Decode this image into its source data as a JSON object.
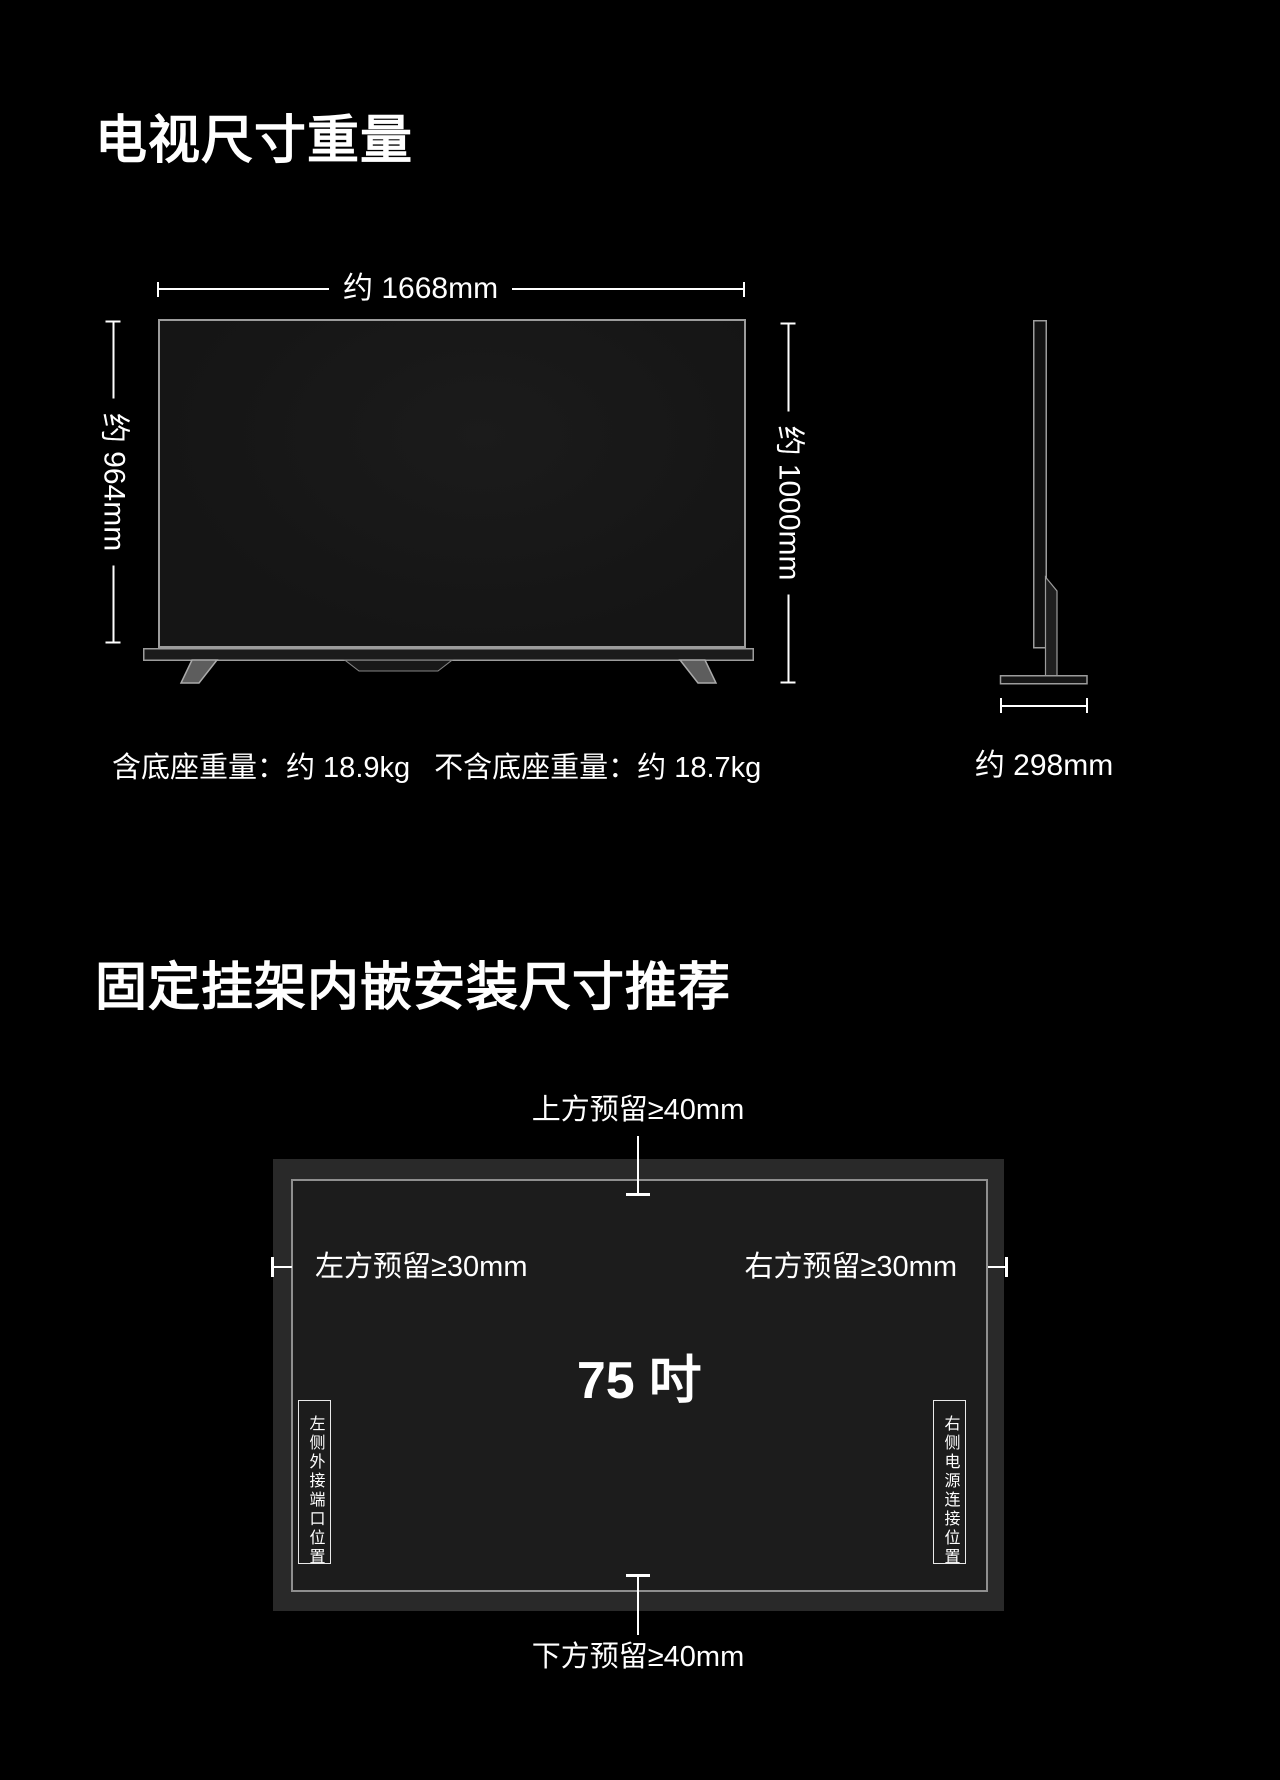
{
  "colors": {
    "background": "#000000",
    "text": "#ffffff",
    "tv_outline": "#9c9c9c",
    "recess_fill": "#292929",
    "screen_fill": "#1c1c1c"
  },
  "section1": {
    "title": "电视尺寸重量",
    "front_view": {
      "width_label": "约 1668mm",
      "height_label": "约 964mm",
      "total_height_label": "约 1000mm"
    },
    "side_view": {
      "depth_label": "约 298mm"
    },
    "weight_with_stand": "含底座重量：约 18.9kg",
    "weight_without_stand": "不含底座重量：约 18.7kg"
  },
  "section2": {
    "title": "固定挂架内嵌安装尺寸推荐",
    "top_clearance": "上方预留≥40mm",
    "left_clearance": "左方预留≥30mm",
    "right_clearance": "右方预留≥30mm",
    "bottom_clearance": "下方预留≥40mm",
    "screen_size": "75 吋",
    "left_port_label": "左侧外接端口位置",
    "right_power_label": "右侧电源连接位置"
  }
}
